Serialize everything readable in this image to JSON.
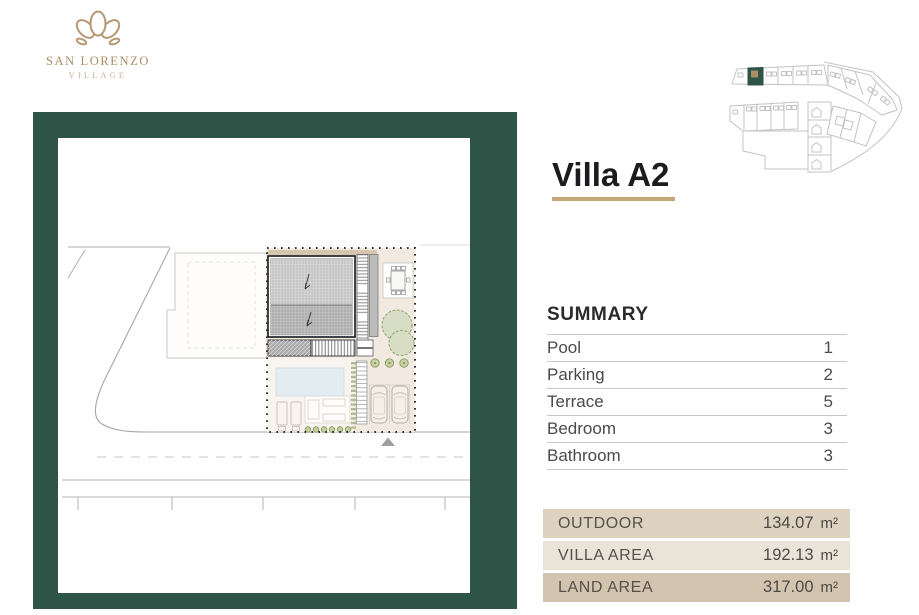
{
  "brand": {
    "name": "SAN LORENZO",
    "tagline": "VILLAGE"
  },
  "page": {
    "title": "Villa A2"
  },
  "summary": {
    "heading": "SUMMARY",
    "rows": [
      {
        "label": "Pool",
        "value": "1"
      },
      {
        "label": "Parking",
        "value": "2"
      },
      {
        "label": "Terrace",
        "value": "5"
      },
      {
        "label": "Bedroom",
        "value": "3"
      },
      {
        "label": "Bathroom",
        "value": "3"
      }
    ]
  },
  "areas": [
    {
      "label": "OUTDOOR",
      "value": "134.07",
      "unit": "m²"
    },
    {
      "label": "VILLA AREA",
      "value": "192.13",
      "unit": "m²"
    },
    {
      "label": "LAND AREA",
      "value": "317.00",
      "unit": "m²"
    }
  ],
  "colors": {
    "brand_green": "#2e5347",
    "brand_gold": "#b59872",
    "title_underline": "#c5a87a",
    "area_row_backgrounds": [
      "#ddd1bf",
      "#eae3d8",
      "#d2c4ae"
    ]
  },
  "map": {
    "highlighted_plot": "Villa A2"
  }
}
